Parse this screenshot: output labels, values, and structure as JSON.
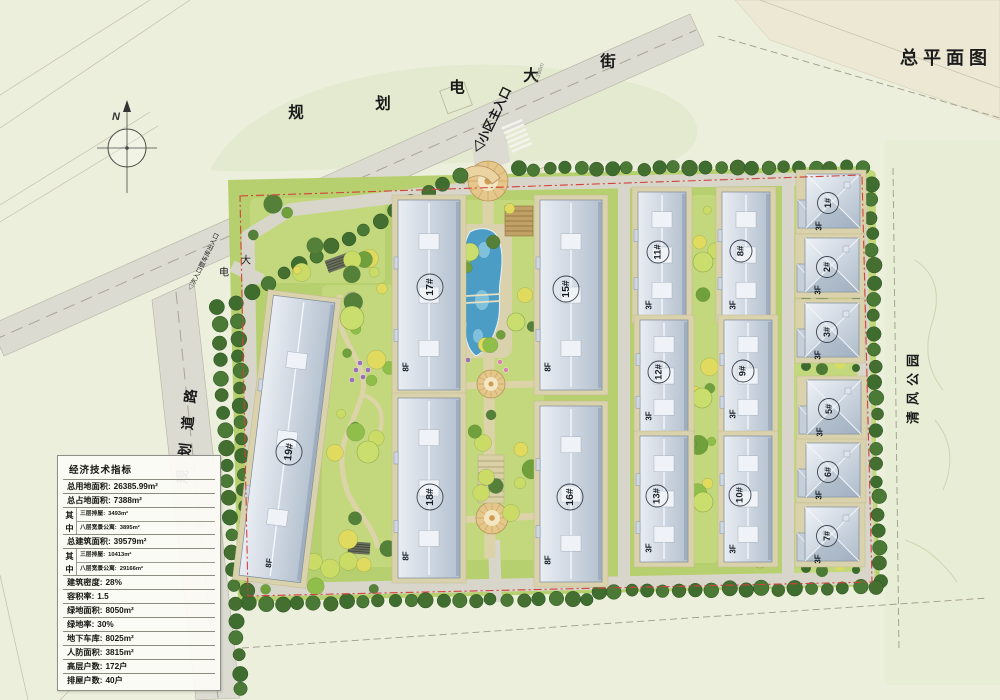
{
  "title": "总平面图",
  "compass_label": "N",
  "streets": {
    "top_street_chars": [
      "规",
      "划",
      "电",
      "大",
      "街"
    ],
    "inner_street_chars": [
      "电",
      "大"
    ],
    "left_road": "规划道路",
    "park": "清风公园"
  },
  "entrances": {
    "main": "◁小区主入口",
    "secondary": "◁次入口暨车库出入口"
  },
  "dimension_note": "5.398m",
  "buildings": {
    "b1": {
      "label": "1#",
      "floors": "3F"
    },
    "b2": {
      "label": "2#",
      "floors": "3F"
    },
    "b3": {
      "label": "3#",
      "floors": "3F"
    },
    "b5": {
      "label": "5#",
      "floors": "3F"
    },
    "b6": {
      "label": "6#",
      "floors": "3F"
    },
    "b7": {
      "label": "7#",
      "floors": "3F"
    },
    "b8": {
      "label": "8#",
      "floors": "3F"
    },
    "b9": {
      "label": "9#",
      "floors": "3F"
    },
    "b10": {
      "label": "10#",
      "floors": "3F"
    },
    "b11": {
      "label": "11#",
      "floors": "3F"
    },
    "b12": {
      "label": "12#",
      "floors": "3F"
    },
    "b13": {
      "label": "13#",
      "floors": "3F"
    },
    "b15": {
      "label": "15#",
      "floors": "8F"
    },
    "b16": {
      "label": "16#",
      "floors": "8F"
    },
    "b17": {
      "label": "17#",
      "floors": "8F"
    },
    "b18": {
      "label": "18#",
      "floors": "8F"
    },
    "b19": {
      "label": "19#",
      "floors": "8F"
    }
  },
  "legend_table": {
    "title": "经济技术指标",
    "rows": [
      {
        "t": "r",
        "label": "总用地面积:",
        "value": "26385.99m²"
      },
      {
        "t": "r",
        "label": "总占地面积:",
        "value": "7388m²"
      },
      {
        "t": "g",
        "key": "其中",
        "subs": [
          [
            "三层排屋:",
            "3493m²"
          ],
          [
            "八层宽景公寓:",
            "3895m²"
          ]
        ]
      },
      {
        "t": "r",
        "label": "总建筑面积:",
        "value": "39579m²"
      },
      {
        "t": "g",
        "key": "其中",
        "subs": [
          [
            "三层排屋:",
            "10413m²"
          ],
          [
            "八层宽景公寓:",
            "29166m²"
          ]
        ]
      },
      {
        "t": "r",
        "label": "建筑密度:",
        "value": "28%"
      },
      {
        "t": "r",
        "label": "容积率:",
        "value": "1.5"
      },
      {
        "t": "r",
        "label": "绿地面积:",
        "value": "8050m²"
      },
      {
        "t": "r",
        "label": "绿地率:",
        "value": "30%"
      },
      {
        "t": "r",
        "label": "地下车库:",
        "value": "8025m²"
      },
      {
        "t": "r",
        "label": "人防面积:",
        "value": "3815m²"
      },
      {
        "t": "r",
        "label": "高层户数:",
        "value": "172户"
      },
      {
        "t": "r",
        "label": "排屋户数:",
        "value": "40户"
      }
    ]
  },
  "colors": {
    "paper": "#ecefdc",
    "lawn": "#b7d06f",
    "garden_light": "#c3d87c",
    "road": "#dcdbd2",
    "inner_road": "#d8d6ca",
    "path_tan": "#ddd3a8",
    "pad_tan": "#d9d2ac",
    "roof_light": "#e9edf3",
    "roof_dark": "#b4c1cf",
    "tree_dark": "#3f6d2f",
    "water": "#4b9dc6",
    "plaza": "#e5c78b",
    "boundary_red": "#d4403a"
  }
}
